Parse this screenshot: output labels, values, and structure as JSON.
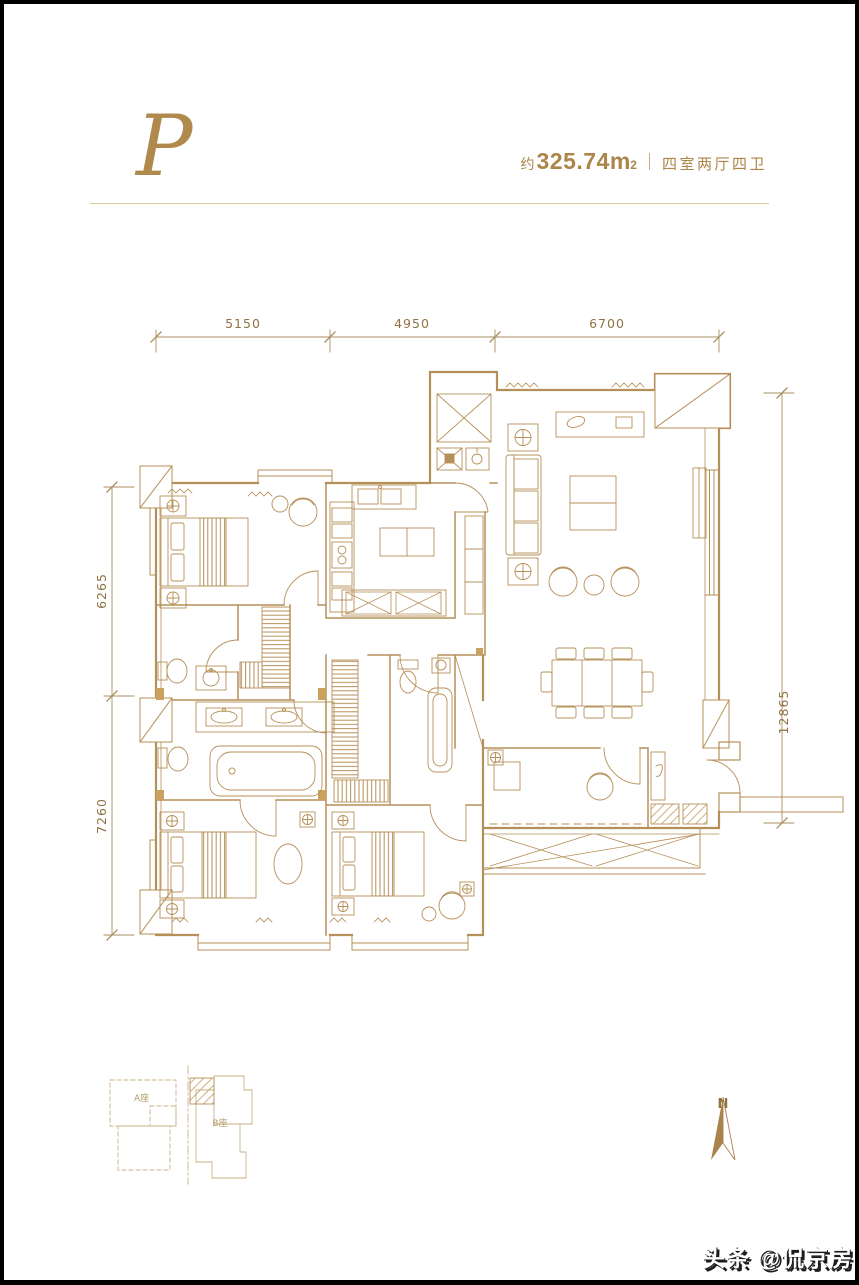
{
  "header": {
    "monogram": "P",
    "area_prefix": "约",
    "area_value": "325.74",
    "area_unit": "m",
    "area_sup": "2",
    "rooms_label": "四室两厅四卫"
  },
  "dimensions": {
    "top": [
      "5150",
      "4950",
      "6700"
    ],
    "left": [
      "6265",
      "7260"
    ],
    "right": [
      "12865"
    ]
  },
  "key_plan": {
    "building_a_label": "A座",
    "building_b_label": "B座"
  },
  "compass": {
    "north_label": "N"
  },
  "watermark": {
    "text": "头条 @侃京房"
  },
  "colors": {
    "accent_gold": "#b08a4c",
    "plan_line": "#b58f58",
    "dim_text": "#8f7344",
    "keyplan_line": "#c9b187"
  }
}
